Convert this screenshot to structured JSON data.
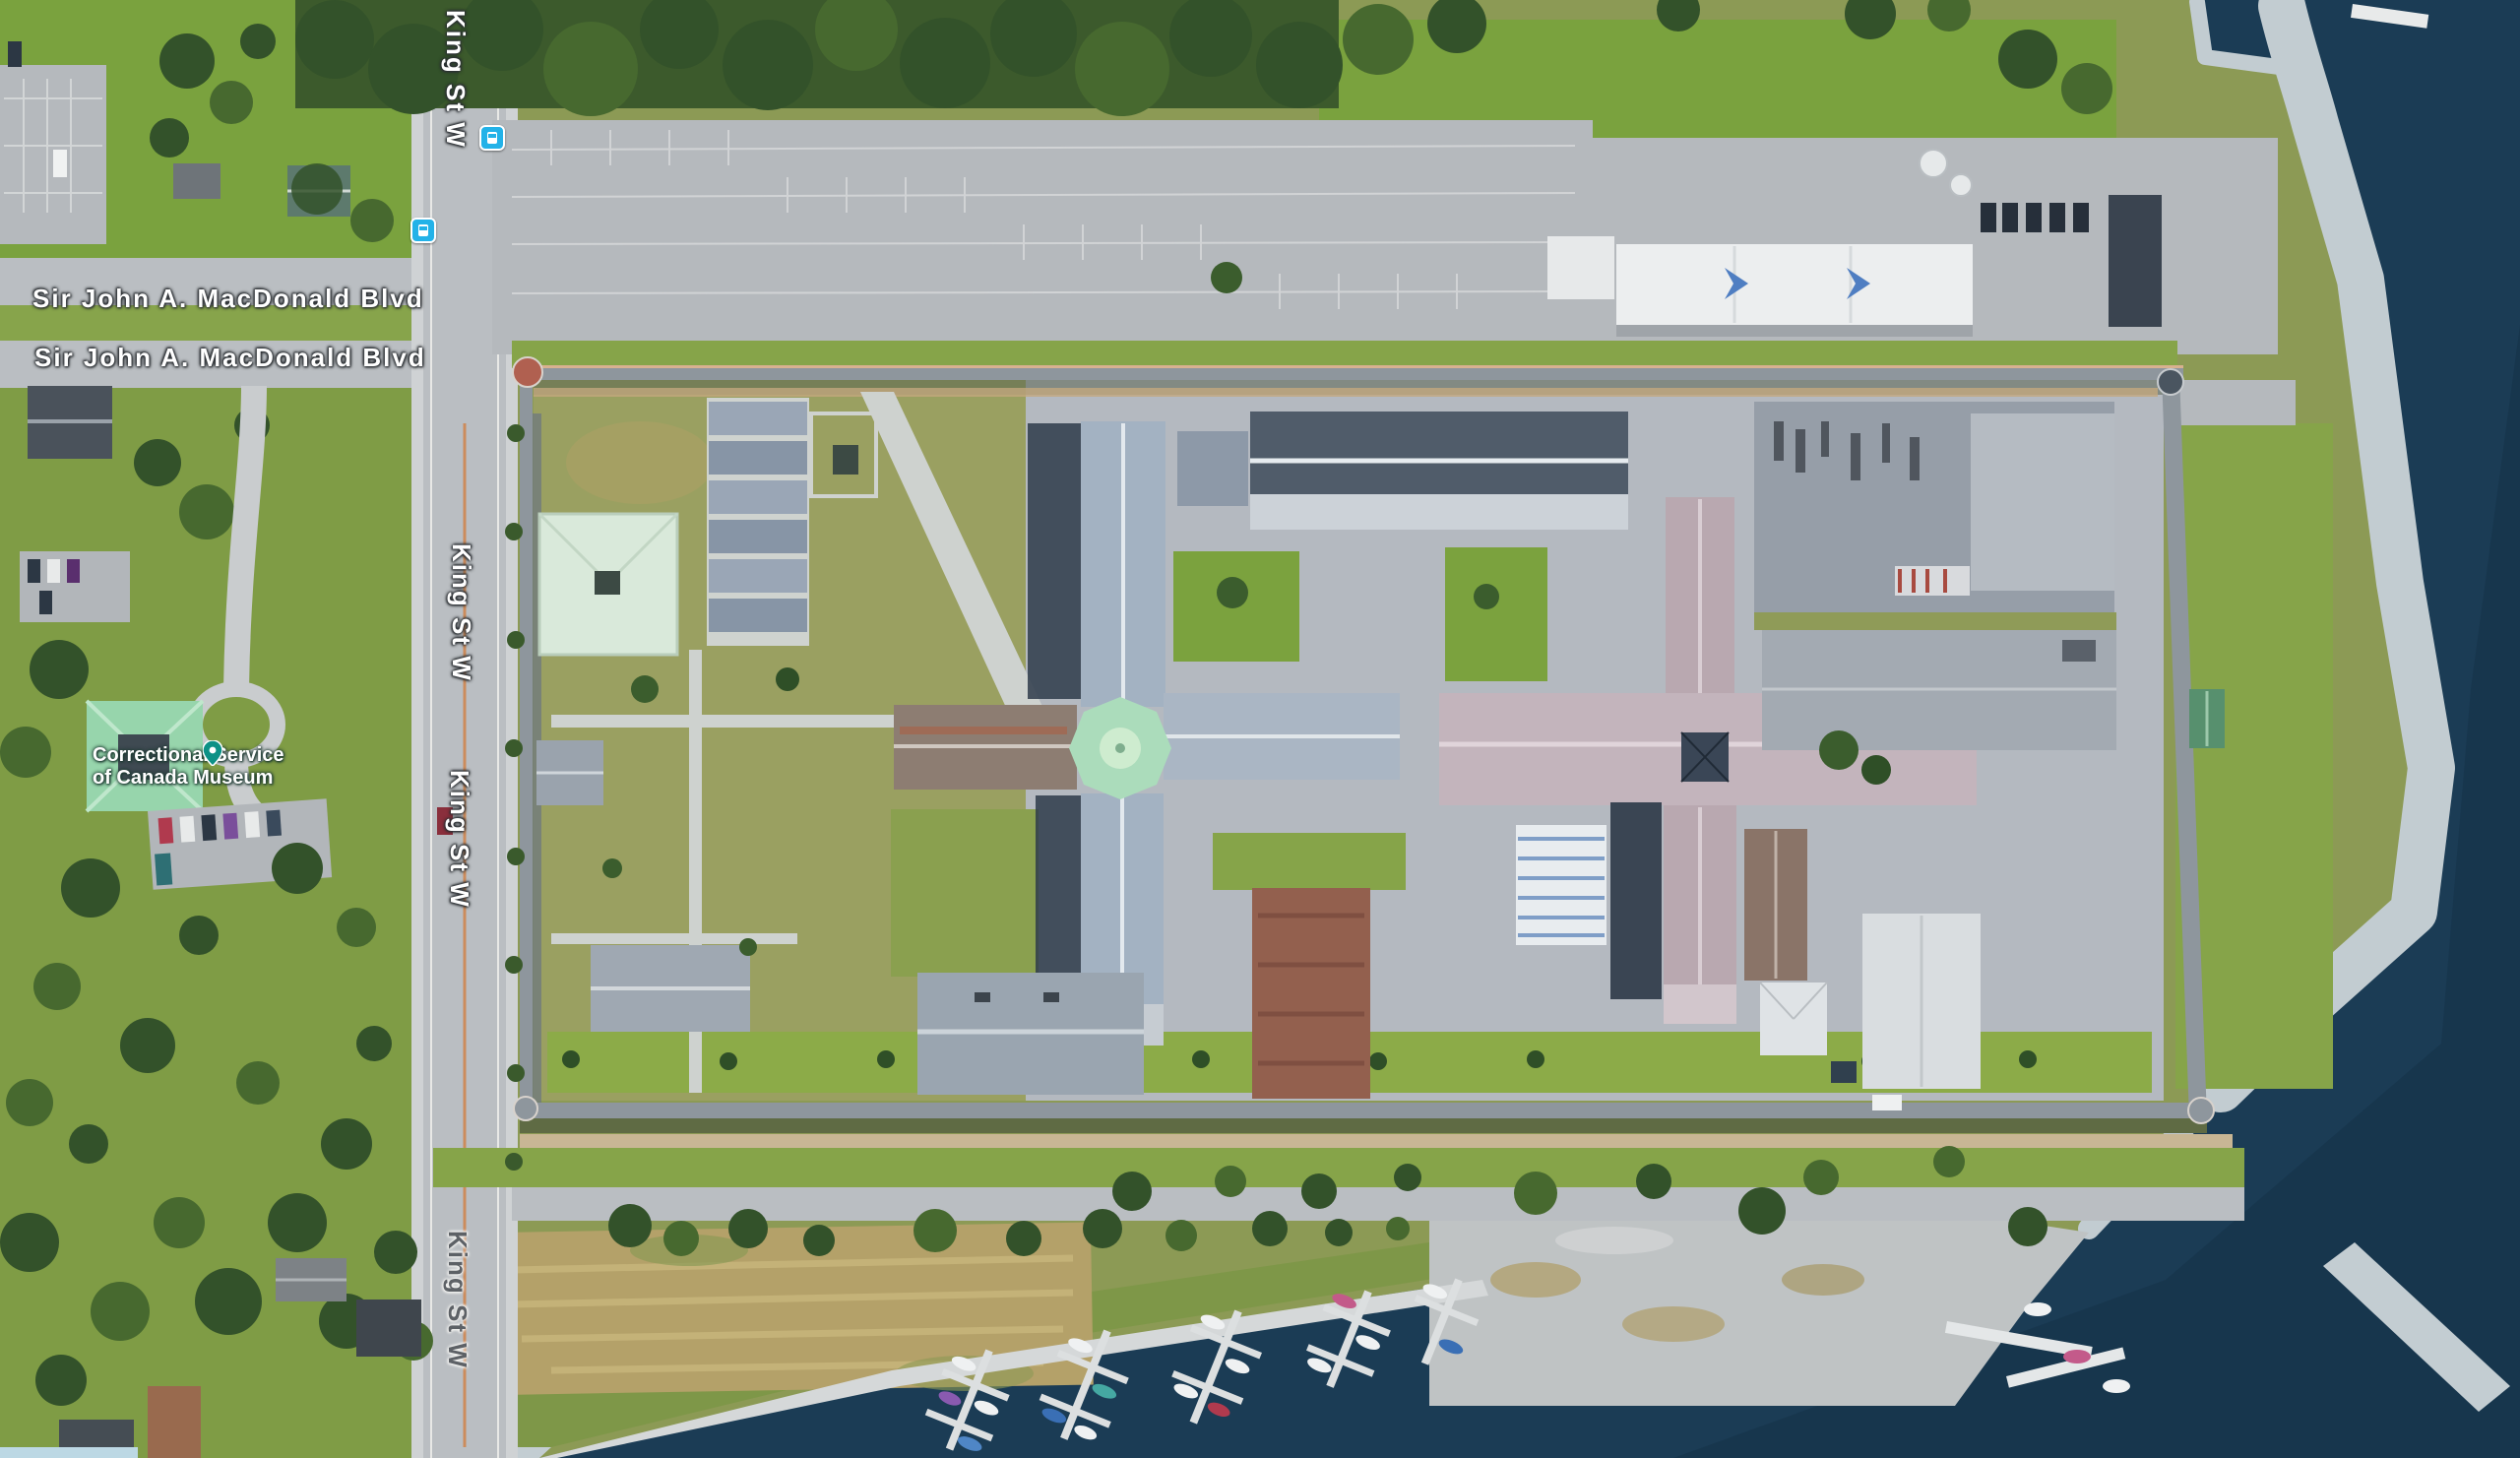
{
  "map": {
    "view_type": "satellite-aerial-imagery",
    "streets": {
      "sir_john_a_macdonald_blvd": "Sir John A. MacDonald Blvd",
      "king_st_w": "King St W"
    },
    "poi": {
      "museum_line1": "Correctional Service",
      "museum_line2": "of Canada Museum"
    },
    "icons": [
      "transit-stop-icon",
      "transit-stop-icon",
      "museum-pin-icon"
    ],
    "features": [
      "lake-water",
      "rocky-shoreline",
      "breakwater",
      "marina-docks",
      "boats",
      "wharf-apron",
      "dry-field",
      "penitentiary-perimeter-wall",
      "corner-towers",
      "main-cellblock-cross-building",
      "central-green-dome",
      "east-cross-building",
      "north-cellblock-building",
      "industrial-flat-roof-buildings",
      "workshop-rows",
      "greenhouse-building",
      "white-warehouse-building",
      "museum-building",
      "parking-lots",
      "cars",
      "trees",
      "lawns",
      "residential-houses",
      "king-st-w-road",
      "sir-john-a-macdonald-blvd-road",
      "perimeter-road"
    ],
    "colors": {
      "water": "#1b3c55",
      "water_deep": "#16334a",
      "rock_shore": "#c2ccd1",
      "grass_bright": "#7aa23e",
      "grass_olive": "#8c9a55",
      "tree_dark": "#33522a",
      "road_gray": "#babec2",
      "pavement": "#b6bac0",
      "field_tan": "#b4a169",
      "wall_gray": "#8e969d",
      "roof_slate": "#a2b1c2",
      "roof_pink": "#c0b2ba",
      "roof_brown": "#8d7d72",
      "dome_mint": "#abdcbb",
      "museum_mint": "#97d5ac",
      "white_building": "#eceeef",
      "red_brick_building": "#93604e",
      "transit_blue": "#23b2e8",
      "poi_teal": "#0d9186",
      "label_white": "#ffffff",
      "label_dark": "#5d6166"
    }
  }
}
